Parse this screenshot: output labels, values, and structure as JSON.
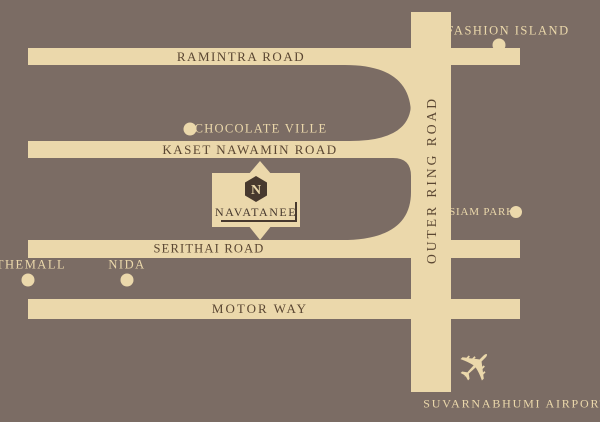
{
  "title": "NAVATANEE location map",
  "colors": {
    "background": "#7b6c64",
    "road": "#ebd8ab",
    "road_text": "#5a4632",
    "badge_background": "#ebd8ab",
    "badge_dark": "#47392e"
  },
  "roads": {
    "ramintra": {
      "label": "RAMINTRA ROAD"
    },
    "kaset": {
      "label": "KASET NAWAMIN ROAD"
    },
    "serithai": {
      "label": "SERITHAI ROAD"
    },
    "motorway": {
      "label": "MOTOR WAY"
    },
    "outer_ring": {
      "label": "OUTER RING ROAD"
    }
  },
  "places": {
    "fashion_island": {
      "label": "FASHION ISLAND"
    },
    "chocolate_ville": {
      "label": "CHOCOLATE VILLE"
    },
    "siam_park": {
      "label": "SIAM PARK"
    },
    "the_mall": {
      "label": "THEMALL"
    },
    "nida": {
      "label": "NIDA"
    },
    "airport": {
      "label": "SUVARNABHUMI AIRPORT"
    }
  },
  "badge": {
    "name": "NAVATANEE",
    "logo_letter": "N"
  },
  "icons": {
    "airplane": "✈"
  }
}
